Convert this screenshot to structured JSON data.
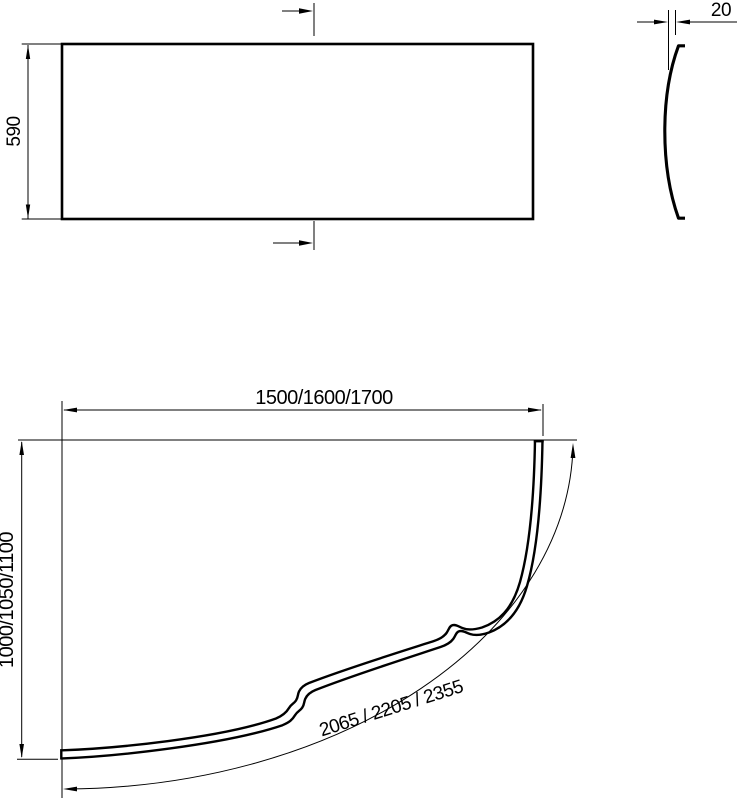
{
  "drawing": {
    "front_view": {
      "height_label": "590"
    },
    "side_view": {
      "thickness_label": "20"
    },
    "plan_view": {
      "width_label": "1500/1600/1700",
      "depth_label": "1000/1050/1100",
      "arc_length_label": "2065 / 2205 / 2355"
    }
  },
  "colors": {
    "line": "#000000",
    "background": "#ffffff"
  }
}
